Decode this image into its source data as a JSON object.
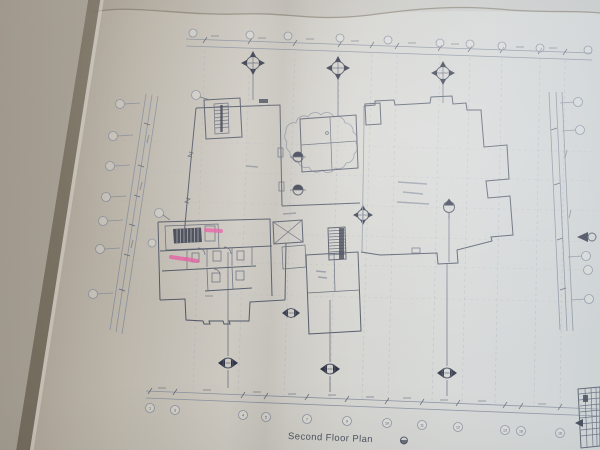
{
  "photo": {
    "plan_title": "Second Floor Plan",
    "bottom_grid_labels": [
      "1",
      "3",
      "4",
      "5",
      "7",
      "9",
      "10",
      "11",
      "12",
      "13",
      "16",
      "18"
    ],
    "pink_highlight_marks": 3,
    "colors": {
      "paper_warm": "#b4ada1",
      "paper_light": "#d9dbda",
      "fold_shadow": "#6e675d",
      "ink": "#4e5565",
      "ink_faint": "#98a0af",
      "highlighter_pink": "#e75da4",
      "dark_fill": "#2f3446"
    }
  }
}
